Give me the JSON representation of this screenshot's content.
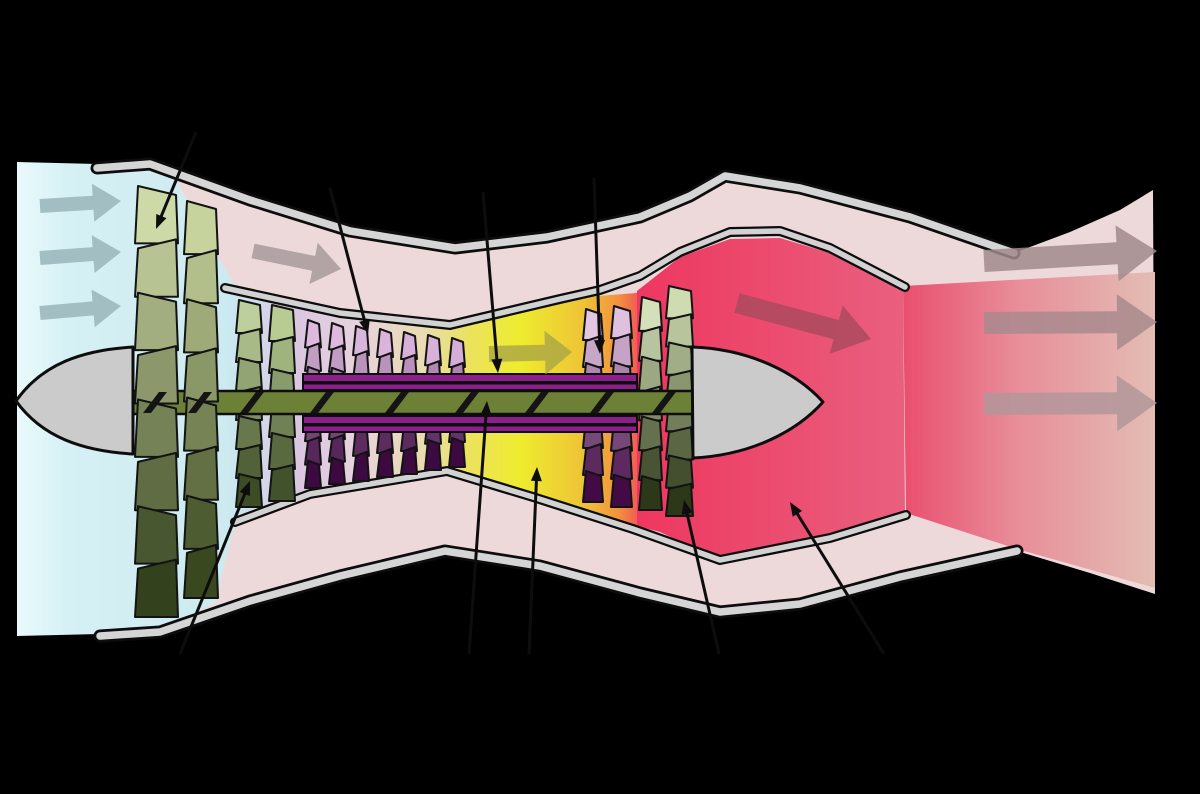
{
  "meta": {
    "title": "Turbofan engine schematic (cutaway flow diagram)",
    "background": "#000000",
    "width": 1200,
    "height": 794
  },
  "parts": {
    "flow_stations": [
      "intake airflow",
      "fan",
      "bypass duct",
      "low-pressure compressor",
      "high-pressure compressor",
      "combustion chamber",
      "high-pressure turbine",
      "low-pressure turbine",
      "nozzle",
      "exhaust plume"
    ],
    "spools": [
      "low-pressure shaft",
      "high-pressure shaft"
    ]
  },
  "palette": {
    "background": "#000000",
    "intake_air": "#cdeaf0",
    "bypass_air": "#eed9da",
    "combustor_yellow": "#eeec2e",
    "exhaust_red": "#ee3760",
    "casing_gray": "#d5d5d5",
    "lp_shaft_green": "#6d8136",
    "hp_shaft_purple": "#8c1f8c",
    "outline": "#0d0d0d"
  },
  "regions": [
    {
      "name": "nacelle-interior-bypass-air",
      "fill": {
        "type": "solid",
        "color": "#eed9da"
      },
      "points": [
        [
          97,
          168
        ],
        [
          150,
          164
        ],
        [
          250,
          200
        ],
        [
          350,
          231
        ],
        [
          455,
          248
        ],
        [
          547,
          237
        ],
        [
          640,
          217
        ],
        [
          690,
          196
        ],
        [
          725,
          176
        ],
        [
          800,
          188
        ],
        [
          910,
          217
        ],
        [
          1014,
          253
        ],
        [
          1070,
          232
        ],
        [
          1120,
          210
        ],
        [
          1153,
          190
        ],
        [
          1155,
          594
        ],
        [
          1090,
          573
        ],
        [
          1017,
          551
        ],
        [
          900,
          577
        ],
        [
          800,
          604
        ],
        [
          720,
          612
        ],
        [
          640,
          593
        ],
        [
          540,
          566
        ],
        [
          445,
          551
        ],
        [
          340,
          576
        ],
        [
          250,
          601
        ],
        [
          160,
          632
        ],
        [
          100,
          636
        ]
      ]
    },
    {
      "name": "intake-airflow-region",
      "fill": {
        "type": "gradient",
        "x1": 17,
        "x2": 237,
        "stops": [
          [
            0,
            "#e9fafc"
          ],
          [
            0.22,
            "#d6f1f5"
          ],
          [
            1,
            "#cce9ef"
          ]
        ]
      },
      "points": [
        [
          17,
          162
        ],
        [
          97,
          164
        ],
        [
          150,
          167
        ],
        [
          176,
          180
        ],
        [
          237,
          290
        ],
        [
          237,
          515
        ],
        [
          215,
          603
        ],
        [
          160,
          630
        ],
        [
          100,
          634
        ],
        [
          17,
          636
        ]
      ]
    },
    {
      "name": "core-airflow-region",
      "fill": {
        "type": "gradient",
        "x1": 222,
        "x2": 648,
        "stops": [
          [
            0,
            "#c9ecf2"
          ],
          [
            0.18,
            "#dbc6e0"
          ],
          [
            0.32,
            "#e7d2dd"
          ],
          [
            0.47,
            "#e9dcb2"
          ],
          [
            0.58,
            "#ebe25e"
          ],
          [
            0.7,
            "#eeec2e"
          ],
          [
            0.85,
            "#eec336"
          ],
          [
            0.93,
            "#f2923e"
          ],
          [
            1,
            "#ee4060"
          ]
        ],
        "_comment": "cyan behind fan, lavender at HP compressor, yellow combustor, orange-red into turbine"
      },
      "points": [
        [
          222,
          286
        ],
        [
          340,
          313
        ],
        [
          450,
          325
        ],
        [
          560,
          299
        ],
        [
          648,
          292
        ],
        [
          648,
          528
        ],
        [
          633,
          528
        ],
        [
          533,
          495
        ],
        [
          447,
          470
        ],
        [
          310,
          492
        ],
        [
          233,
          521
        ]
      ]
    },
    {
      "name": "core-exhaust-region",
      "fill": {
        "type": "gradient",
        "x1": 637,
        "x2": 905,
        "stops": [
          [
            0,
            "#ee3760"
          ],
          [
            1,
            "#e9607e"
          ]
        ]
      },
      "points": [
        [
          637,
          291
        ],
        [
          680,
          257
        ],
        [
          730,
          239
        ],
        [
          780,
          238
        ],
        [
          830,
          253
        ],
        [
          903,
          288
        ],
        [
          905,
          513
        ],
        [
          830,
          539
        ],
        [
          720,
          560
        ],
        [
          660,
          532
        ],
        [
          637,
          526
        ]
      ]
    },
    {
      "name": "exhaust-plume-region",
      "fill": {
        "type": "gradient",
        "x1": 903,
        "x2": 1155,
        "stops": [
          [
            0,
            "#e94f6e"
          ],
          [
            0.45,
            "#e88d99"
          ],
          [
            1,
            "#e3bdb4"
          ]
        ]
      },
      "points": [
        [
          903,
          286
        ],
        [
          1155,
          272
        ],
        [
          1155,
          588
        ],
        [
          1017,
          549
        ],
        [
          906,
          513
        ]
      ]
    }
  ],
  "bands": [
    {
      "name": "outer-nacelle-casing-top",
      "outer": 13,
      "inner": 7.5,
      "gray": "#d5d5d5",
      "points": [
        [
          97,
          168
        ],
        [
          150,
          164
        ],
        [
          250,
          200
        ],
        [
          350,
          231
        ],
        [
          455,
          248
        ],
        [
          547,
          237
        ],
        [
          640,
          217
        ],
        [
          690,
          196
        ],
        [
          725,
          176
        ],
        [
          800,
          188
        ],
        [
          910,
          217
        ],
        [
          1014,
          253
        ]
      ]
    },
    {
      "name": "outer-nacelle-casing-bottom",
      "outer": 13,
      "inner": 7.5,
      "gray": "#d5d5d5",
      "points": [
        [
          100,
          636
        ],
        [
          160,
          632
        ],
        [
          250,
          601
        ],
        [
          340,
          576
        ],
        [
          445,
          551
        ],
        [
          540,
          566
        ],
        [
          640,
          593
        ],
        [
          720,
          612
        ],
        [
          800,
          604
        ],
        [
          900,
          577
        ],
        [
          1017,
          551
        ]
      ]
    },
    {
      "name": "core-cowl-top",
      "outer": 10,
      "inner": 5.5,
      "gray": "#d2d2d2",
      "points": [
        [
          225,
          288
        ],
        [
          340,
          313
        ],
        [
          450,
          325
        ],
        [
          560,
          299
        ],
        [
          600,
          290
        ],
        [
          640,
          276
        ],
        [
          680,
          252
        ],
        [
          730,
          232
        ],
        [
          780,
          231
        ],
        [
          830,
          248
        ],
        [
          905,
          287
        ]
      ]
    },
    {
      "name": "core-cowl-bottom",
      "outer": 10,
      "inner": 5.5,
      "gray": "#d2d2d2",
      "points": [
        [
          235,
          522
        ],
        [
          310,
          494
        ],
        [
          447,
          471
        ],
        [
          533,
          497
        ],
        [
          633,
          529
        ],
        [
          720,
          560
        ],
        [
          830,
          538
        ],
        [
          906,
          515
        ]
      ]
    }
  ],
  "solids": [
    {
      "name": "inlet-spinner-cone",
      "d": "M 16 401 C 42 364 82 350 133 347 L 133 454 C 82 451 42 437 16 401 Z",
      "fill": "#cbcbcb",
      "stroke": "#0d0d0d",
      "sw": 3
    },
    {
      "name": "tail-cone",
      "d": "M 692 347 C 750 349 797 373 823 402 C 797 431 752 455 693 458 Z",
      "fill": "#cbcbcb",
      "stroke": "#0d0d0d",
      "sw": 3
    }
  ],
  "shaft": {
    "hp_bands": [
      {
        "x": 303,
        "y": 374,
        "w": 334,
        "h": 16
      },
      {
        "x": 303,
        "y": 416,
        "w": 334,
        "h": 16
      }
    ],
    "hp_midlines": [
      {
        "x": 303,
        "y": 381,
        "w": 334,
        "h": 3.5
      },
      {
        "x": 303,
        "y": 423,
        "w": 334,
        "h": 3.5
      }
    ],
    "hp_color": "#8c1f8c",
    "lp_band": {
      "x": 128,
      "y": 391,
      "w": 566,
      "h": 23
    },
    "lp_color": "#6d8136",
    "outline": "#0d0d0d",
    "hatch_x": [
      143,
      188,
      240,
      310,
      385,
      455,
      525,
      590,
      652
    ],
    "hatch_color": "#141414"
  },
  "blade_rows": [
    {
      "name": "fan-stage-1",
      "layer": "fan",
      "x": 135,
      "w": 43,
      "top": 186,
      "bottom": 613,
      "seg": 54,
      "tilt": 9,
      "colors": [
        "#ced9a8",
        "#33411c"
      ]
    },
    {
      "name": "fan-stage-2",
      "layer": "fan",
      "x": 184,
      "w": 34,
      "top": 201,
      "bottom": 594,
      "seg": 52,
      "tilt": 8,
      "colors": [
        "#c6d39c",
        "#3a4820"
      ]
    },
    {
      "name": "lp-compressor-stage-1",
      "layer": "core",
      "x": 236,
      "w": 26,
      "top": 300,
      "bottom": 503,
      "seg": 31,
      "tilt": 5,
      "colors": [
        "#bdd09c",
        "#3c4c24"
      ]
    },
    {
      "name": "lp-compressor-stage-2",
      "layer": "core",
      "x": 269,
      "w": 26,
      "top": 305,
      "bottom": 497,
      "seg": 31,
      "tilt": 5,
      "colors": [
        "#b7cb93",
        "#41522c"
      ]
    },
    {
      "name": "hp-compressor-stage-1",
      "layer": "core",
      "x": 305,
      "w": 16,
      "top": 320,
      "bottom": 484,
      "seg": 24,
      "tilt": 4,
      "colors": [
        "#dcb9dd",
        "#3c0940"
      ]
    },
    {
      "name": "hp-compressor-stage-2",
      "layer": "core",
      "x": 329,
      "w": 16,
      "top": 323,
      "bottom": 480,
      "seg": 24,
      "tilt": 4,
      "colors": [
        "#dcb9dd",
        "#3c0940"
      ]
    },
    {
      "name": "hp-compressor-stage-3",
      "layer": "core",
      "x": 353,
      "w": 16,
      "top": 326,
      "bottom": 477,
      "seg": 24,
      "tilt": 4,
      "colors": [
        "#dab5db",
        "#3c0940"
      ]
    },
    {
      "name": "hp-compressor-stage-4",
      "layer": "core",
      "x": 377,
      "w": 16,
      "top": 329,
      "bottom": 473,
      "seg": 24,
      "tilt": 4,
      "colors": [
        "#dab5db",
        "#3c0940"
      ]
    },
    {
      "name": "hp-compressor-stage-5",
      "layer": "core",
      "x": 401,
      "w": 16,
      "top": 332,
      "bottom": 470,
      "seg": 24,
      "tilt": 4,
      "colors": [
        "#d8b1da",
        "#3c0940"
      ]
    },
    {
      "name": "hp-compressor-stage-6",
      "layer": "core",
      "x": 425,
      "w": 16,
      "top": 335,
      "bottom": 466,
      "seg": 24,
      "tilt": 4,
      "colors": [
        "#d8b1da",
        "#3c0940"
      ]
    },
    {
      "name": "hp-compressor-stage-7",
      "layer": "core",
      "x": 449,
      "w": 16,
      "top": 338,
      "bottom": 463,
      "seg": 24,
      "tilt": 4,
      "colors": [
        "#d6add8",
        "#3c0940"
      ]
    },
    {
      "name": "hp-turbine-stage-1",
      "layer": "core",
      "x": 583,
      "w": 20,
      "top": 309,
      "bottom": 498,
      "seg": 27,
      "tilt": 5,
      "colors": [
        "#e2c6e2",
        "#420b46"
      ]
    },
    {
      "name": "hp-turbine-stage-2",
      "layer": "core",
      "x": 611,
      "w": 21,
      "top": 306,
      "bottom": 503,
      "seg": 27,
      "tilt": 5,
      "colors": [
        "#dfc0df",
        "#420b46"
      ]
    },
    {
      "name": "lp-turbine-stage-1",
      "layer": "core",
      "x": 639,
      "w": 23,
      "top": 297,
      "bottom": 506,
      "seg": 28,
      "tilt": 5,
      "colors": [
        "#d4e0ba",
        "#2c3818"
      ]
    },
    {
      "name": "lp-turbine-stage-2",
      "layer": "core",
      "x": 666,
      "w": 27,
      "top": 286,
      "bottom": 512,
      "seg": 28,
      "tilt": 5,
      "colors": [
        "#cfdcb2",
        "#2c3818"
      ]
    }
  ],
  "flow_arrows": [
    {
      "name": "intake-air-arrow-1",
      "x1": 40,
      "y1": 206,
      "x2": 121,
      "y2": 201,
      "shaft": 14,
      "headW": 38,
      "headL": 28,
      "fill": "#a3bec2",
      "op": 1
    },
    {
      "name": "intake-air-arrow-2",
      "x1": 40,
      "y1": 258,
      "x2": 121,
      "y2": 252,
      "shaft": 14,
      "headW": 38,
      "headL": 28,
      "fill": "#a3bec2",
      "op": 1
    },
    {
      "name": "intake-air-arrow-3",
      "x1": 40,
      "y1": 313,
      "x2": 121,
      "y2": 306,
      "shaft": 14,
      "headW": 38,
      "headL": 28,
      "fill": "#a3bec2",
      "op": 1
    },
    {
      "name": "bypass-flow-arrow",
      "x1": 253,
      "y1": 251,
      "x2": 341,
      "y2": 269,
      "shaft": 15,
      "headW": 42,
      "headL": 28,
      "fill": "#b2a3a5",
      "op": 1
    },
    {
      "name": "combustor-flow-arrow",
      "x1": 489,
      "y1": 354,
      "x2": 572,
      "y2": 352,
      "shaft": 16,
      "headW": 44,
      "headL": 27,
      "fill": "#aaa545",
      "op": 0.8
    },
    {
      "name": "core-exhaust-flow-arrow",
      "x1": 737,
      "y1": 303,
      "x2": 871,
      "y2": 339,
      "shaft": 20,
      "headW": 50,
      "headL": 36,
      "fill": "#ab4a5e",
      "op": 0.85
    },
    {
      "name": "outlet-flow-arrow-1",
      "x1": 984,
      "y1": 261,
      "x2": 1157,
      "y2": 251,
      "shaft": 22,
      "headW": 56,
      "headL": 40,
      "fill": "#a18a8c",
      "op": 0.85
    },
    {
      "name": "outlet-flow-arrow-2",
      "x1": 984,
      "y1": 323,
      "x2": 1157,
      "y2": 322,
      "shaft": 22,
      "headW": 56,
      "headL": 40,
      "fill": "#a8898d",
      "op": 0.85
    },
    {
      "name": "outlet-flow-arrow-3",
      "x1": 984,
      "y1": 404,
      "x2": 1157,
      "y2": 403,
      "shaft": 22,
      "headW": 56,
      "headL": 40,
      "fill": "#b2969a",
      "op": 0.85
    }
  ],
  "leader_lines": [
    {
      "name": "fan-label-line",
      "from": [
        196,
        132
      ],
      "tip": [
        156,
        229
      ]
    },
    {
      "name": "hp-compressor-label-line",
      "from": [
        330,
        188
      ],
      "tip": [
        368,
        334
      ]
    },
    {
      "name": "hp-shaft-label-line",
      "from": [
        483,
        192
      ],
      "tip": [
        498,
        373
      ]
    },
    {
      "name": "hp-turbine-label-line",
      "from": [
        594,
        178
      ],
      "tip": [
        600,
        354
      ]
    },
    {
      "name": "lp-compressor-label-line",
      "from": [
        180,
        654
      ],
      "tip": [
        250,
        481
      ]
    },
    {
      "name": "lp-shaft-label-line",
      "from": [
        469,
        654
      ],
      "tip": [
        487,
        401
      ]
    },
    {
      "name": "combustion-chamber-label-line",
      "from": [
        529,
        654
      ],
      "tip": [
        537,
        467
      ]
    },
    {
      "name": "lp-turbine-label-line",
      "from": [
        719,
        654
      ],
      "tip": [
        684,
        500
      ]
    },
    {
      "name": "nozzle-exhaust-label-line",
      "from": [
        884,
        654
      ],
      "tip": [
        790,
        502
      ]
    }
  ]
}
